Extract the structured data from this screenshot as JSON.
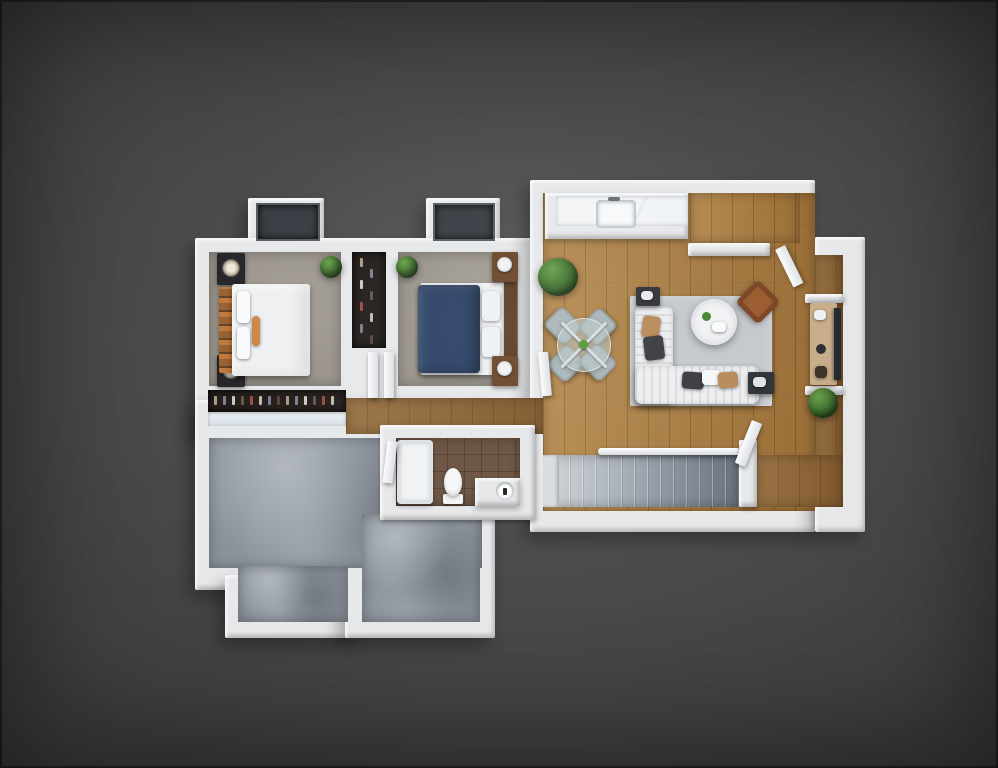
{
  "scene": {
    "type": "3d-floorplan-render",
    "view": "top-down dollhouse",
    "description": "Top-down 3D rendering of an apartment floor plan: two carpeted bedrooms with beds and closets, open living-dining room with hardwood floor, sectional sofa, rug, coffee table, dining set and TV console, bathroom with tub, toilet and vanity, carpeted staircase, entry nook, and a large unfinished concrete room, on a dark gray background."
  },
  "palette": {
    "bg": "#4a4a48",
    "bg-center": "#585856",
    "bg-outer": "#3b3b39",
    "wall": "#e7e8ea",
    "window-pane": "#3a3e44",
    "wood": "#a97b3f",
    "wood-dark": "#8a6132",
    "carpet": "#9a948b",
    "concrete": "#8a9199",
    "tile": "#6f5847",
    "rug": "#c5c9cd",
    "sofa": "#eceef0",
    "coffee-table": "#f1f2f4",
    "bed-white": "#eff0f2",
    "bed-blue": "#2b4165",
    "headboard": "#8a5a33",
    "nightstand-dark": "#26262b",
    "nightstand-wood": "#6b4629",
    "plant": "#3e6b2e",
    "plant-light": "#67a14a",
    "accent-chair": "#9a5a2e",
    "dining-chair": "#a9b5b9",
    "console": "#c9ad8a",
    "tv": "#26292e",
    "closet-dark": "#241f1c",
    "shelf": "#d6dee4"
  },
  "rooms": [
    {
      "name": "bedroom-1",
      "floor": "carpet"
    },
    {
      "name": "bedroom-2",
      "floor": "carpet"
    },
    {
      "name": "closet-between-bedrooms",
      "floor": "dark"
    },
    {
      "name": "wardrobe-closet",
      "floor": "dark"
    },
    {
      "name": "hallway",
      "floor": "wood"
    },
    {
      "name": "living-dining-room",
      "floor": "wood"
    },
    {
      "name": "kitchenette-counter",
      "floor": "counter"
    },
    {
      "name": "entry-alcove",
      "floor": "wood"
    },
    {
      "name": "bathroom",
      "floor": "tile"
    },
    {
      "name": "stairwell",
      "floor": "stair-carpet"
    },
    {
      "name": "entry-landing",
      "floor": "wood"
    },
    {
      "name": "unfinished-room",
      "floor": "concrete"
    }
  ],
  "furniture": [
    "white-double-bed",
    "blue-double-bed",
    "nightstands-with-lamps",
    "nightstands-with-clocks",
    "sectional-sofa",
    "area-rug",
    "round-coffee-table",
    "leather-accent-chair",
    "side-tables",
    "glass-dining-table",
    "dining-chairs",
    "tv-console",
    "wall-tv",
    "kitchen-sink",
    "bathtub",
    "toilet",
    "vanity-sink",
    "potted-plants",
    "bay-windows",
    "open-doors",
    "stair-railing"
  ],
  "closet_clothes_colors": [
    "#b9a089",
    "#8d7f98",
    "#d9d2c8",
    "#6b5b4d",
    "#a34f42",
    "#c8c2b6",
    "#7a8699",
    "#59493f"
  ]
}
